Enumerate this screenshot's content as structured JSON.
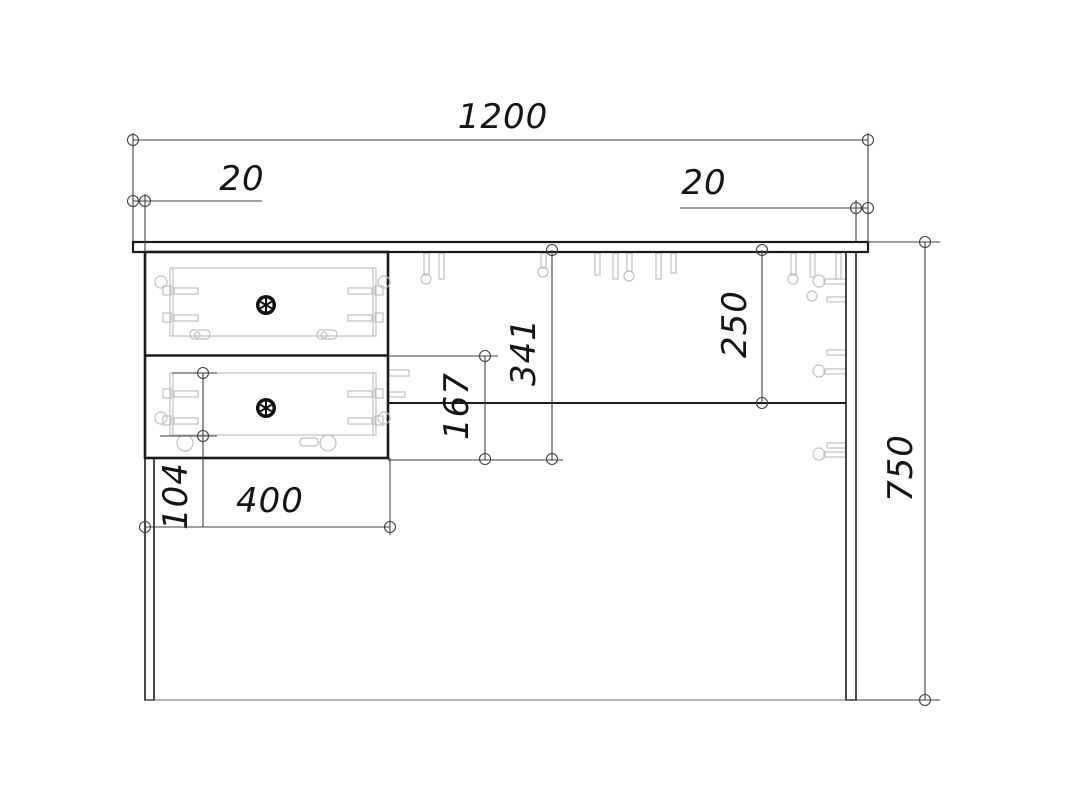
{
  "drawing": {
    "subject": "desk-with-two-drawers-front-elevation",
    "style": "cad-assembly-drawing",
    "colors": {
      "background": "#ffffff",
      "outline": "#1b1b1b",
      "dimension_line": "#3f3f3f",
      "hidden_detail": "#c0c0c0",
      "text": "#141414"
    },
    "dimensions": {
      "overall_width": "1200",
      "left_overhang": "20",
      "right_overhang": "20",
      "drawer_block_height": "341",
      "lower_drawer_front_height": "167",
      "back_rail_drop": "250",
      "drawer_side_height": "104",
      "drawer_block_width": "400",
      "overall_height": "750"
    }
  }
}
